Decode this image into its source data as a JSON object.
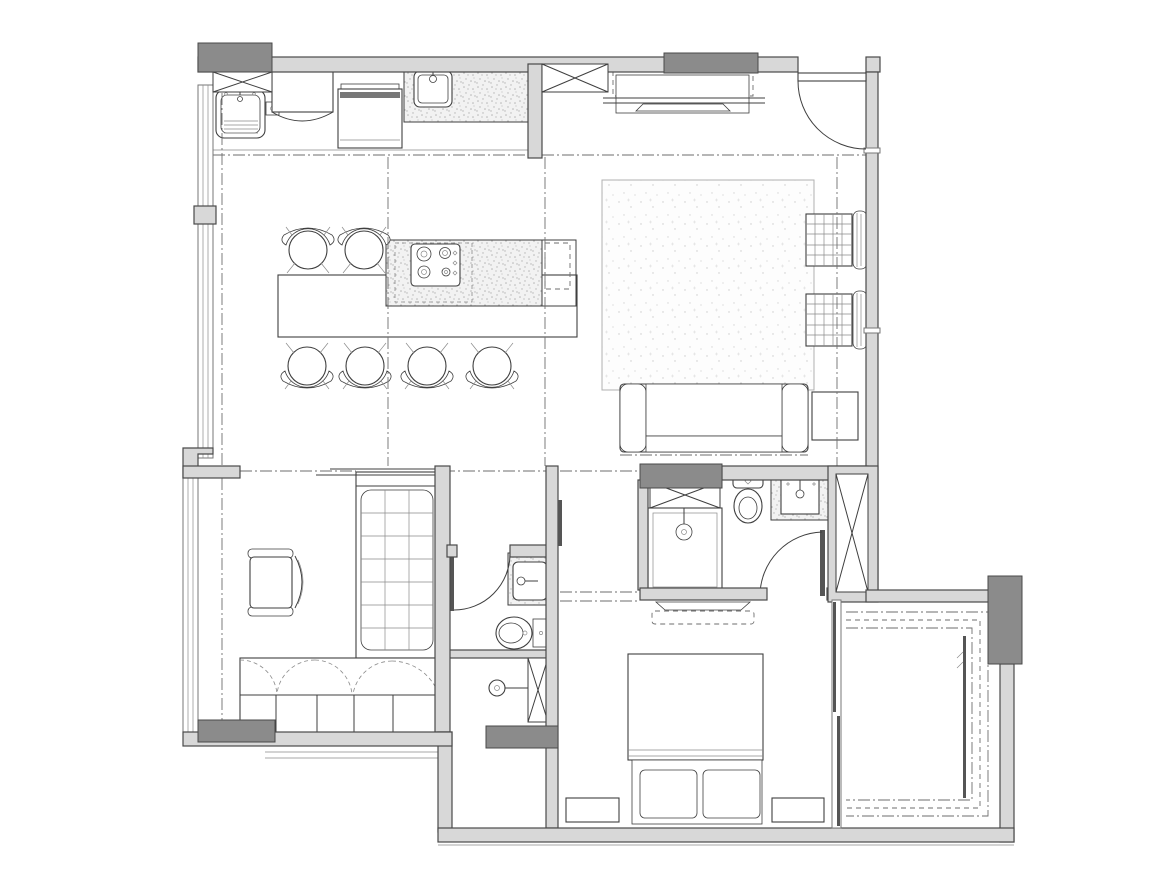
{
  "canvas": {
    "width": 1170,
    "height": 896,
    "background": "#ffffff"
  },
  "colors": {
    "paper": "#ffffff",
    "wall-fill": "#d8d8d8",
    "wall-stroke": "#4a4a4a",
    "column-fill": "#8b8b8b",
    "line": "#3f3f3f",
    "line-light": "#8a8a8a",
    "dash": "#6e6e6e",
    "stipple-dot": "#b5b5b5",
    "rug-dot": "#cccccc"
  },
  "drawing": {
    "type": "architectural-floor-plan",
    "style": "black-and-white CAD top view, no text labels",
    "rooms": [
      {
        "name": "kitchen-dining",
        "fixtures": [
          "laundry-sink",
          "tap-box",
          "refrigerator",
          "oven",
          "kitchen-sink",
          "stippled-counter",
          "island-counter",
          "cooktop-4-burner",
          "dining-table",
          "dining-chairs-x6",
          "duct-shaft-x"
        ]
      },
      {
        "name": "living-room",
        "fixtures": [
          "area-rug",
          "sofa",
          "armchair-x2",
          "side-table",
          "tv-screen",
          "tv-cabinet-dashed",
          "entry-door-swing"
        ]
      },
      {
        "name": "study-bedroom",
        "fixtures": [
          "single-bed-grid-mattress",
          "desk-chair",
          "wardrobe-scallop-doors",
          "window-wall"
        ]
      },
      {
        "name": "guest-bathroom",
        "fixtures": [
          "washbasin-stipple-counter",
          "toilet",
          "shower-head",
          "duct-shaft-x",
          "door-swing"
        ]
      },
      {
        "name": "corridor",
        "fixtures": [
          "ceiling-dash-lines",
          "door-leaf"
        ]
      },
      {
        "name": "master-bathroom",
        "fixtures": [
          "shower-tray",
          "shower-head",
          "duct-shaft-x",
          "toilet",
          "washbasin-stipple-counter",
          "door-swing",
          "closet-shaft-x"
        ]
      },
      {
        "name": "master-bedroom",
        "fixtures": [
          "double-bed",
          "pillows-x2",
          "nightstand-x2",
          "tv-screen",
          "tv-cabinet-dashed",
          "sliding-door"
        ]
      },
      {
        "name": "balcony",
        "fixtures": [
          "curtain-track-dashed-u",
          "glazing-line",
          "column",
          "perimeter-walls"
        ]
      }
    ],
    "structure": [
      "exterior-walls",
      "interior-partitions",
      "columns-gray",
      "window-walls",
      "x-marked-shafts",
      "dash-dot-ceiling-lines"
    ]
  }
}
